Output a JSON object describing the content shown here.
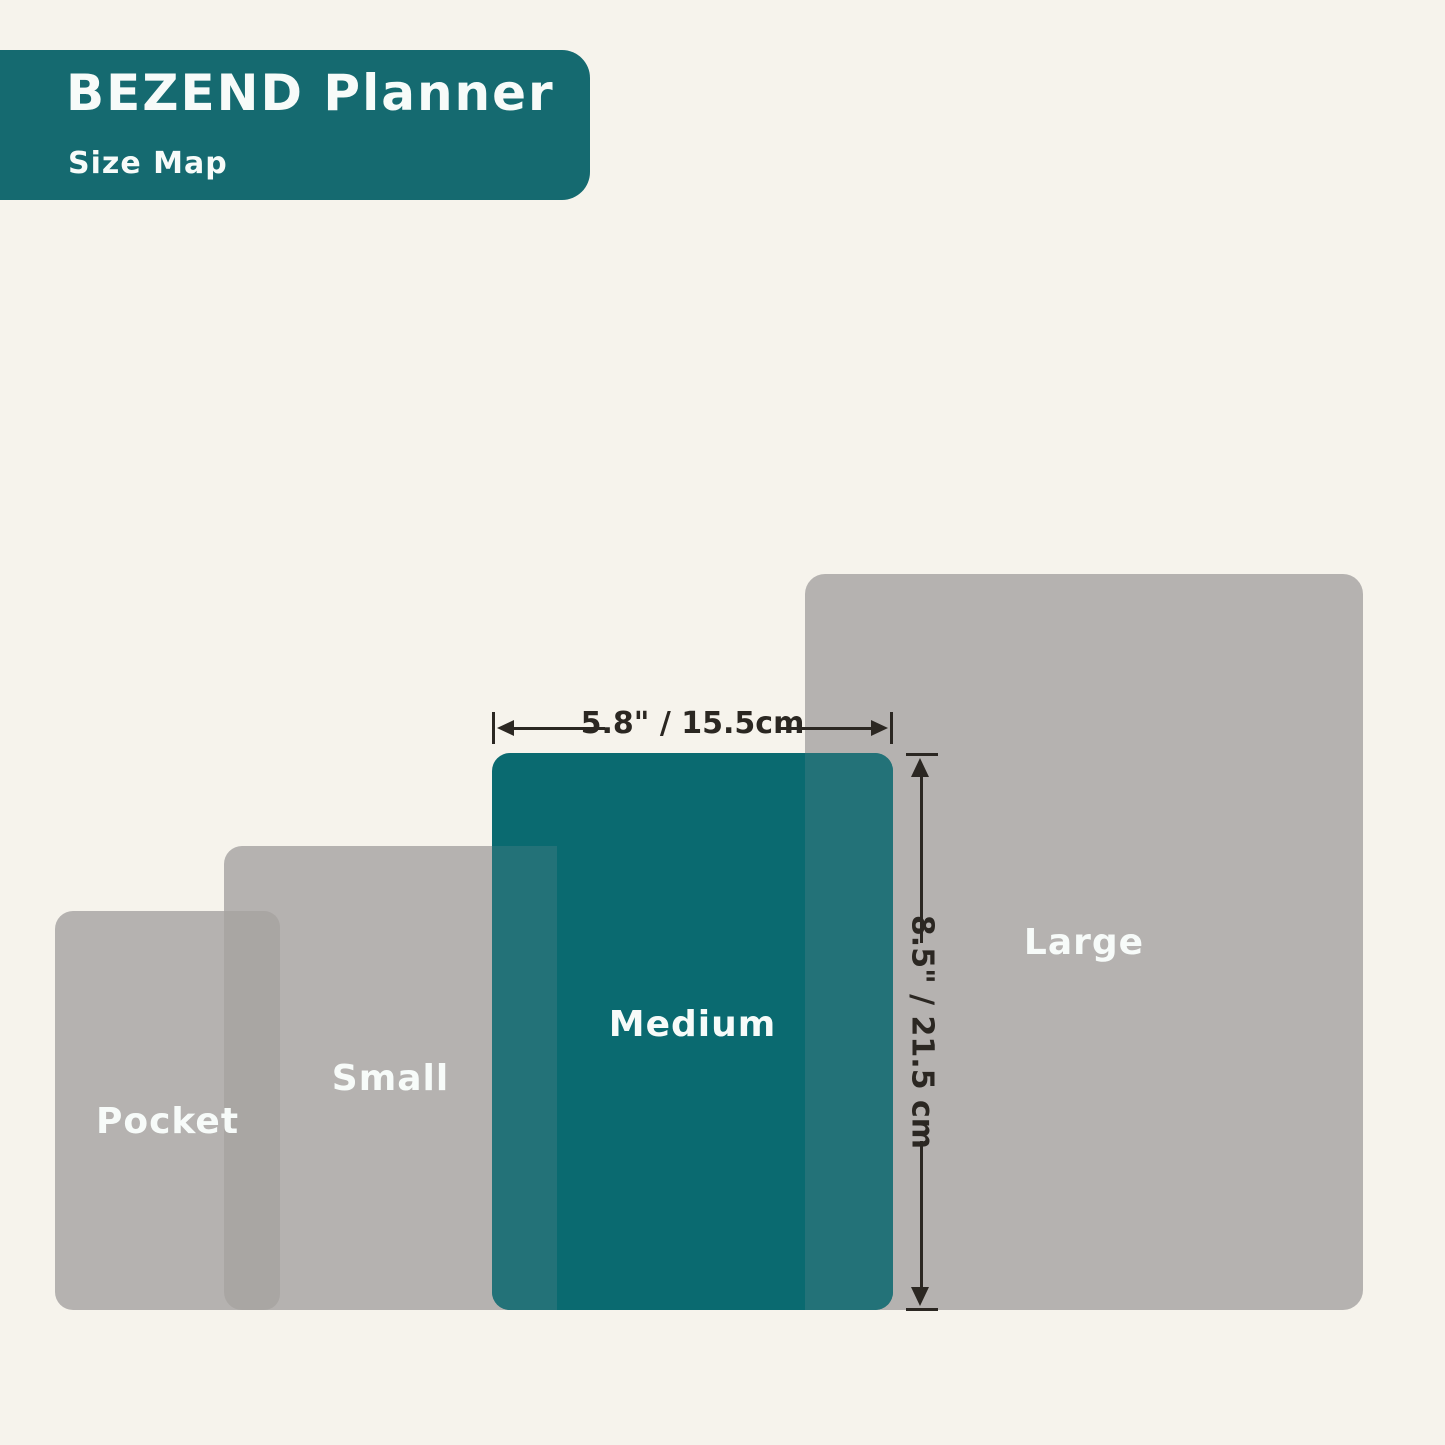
{
  "header": {
    "title": "BEZEND Planner",
    "subtitle": "Size Map"
  },
  "diagram": {
    "description_implied": "Size Map comparison of four planner sizes",
    "sizes": [
      {
        "id": "pocket",
        "label": "Pocket"
      },
      {
        "id": "small",
        "label": "Small"
      },
      {
        "id": "medium",
        "label": "Medium",
        "width": "5.8\" / 15.5cm",
        "height": "8.5\" / 21.5 cm",
        "highlighted": true
      },
      {
        "id": "large",
        "label": "Large"
      }
    ]
  },
  "dimensions": {
    "width_label": "5.8\" / 15.5cm",
    "height_label": "8.5\" / 21.5 cm"
  },
  "colors": {
    "bg": "#f6f3ec",
    "teal": "#0a6a70",
    "teal-header": "#156a70",
    "teal-overlap": "#237278",
    "gray": "#b5b2b0",
    "gray-overlap": "#a9a6a3",
    "ink": "#2b2722",
    "label": "#f7fbf9"
  }
}
